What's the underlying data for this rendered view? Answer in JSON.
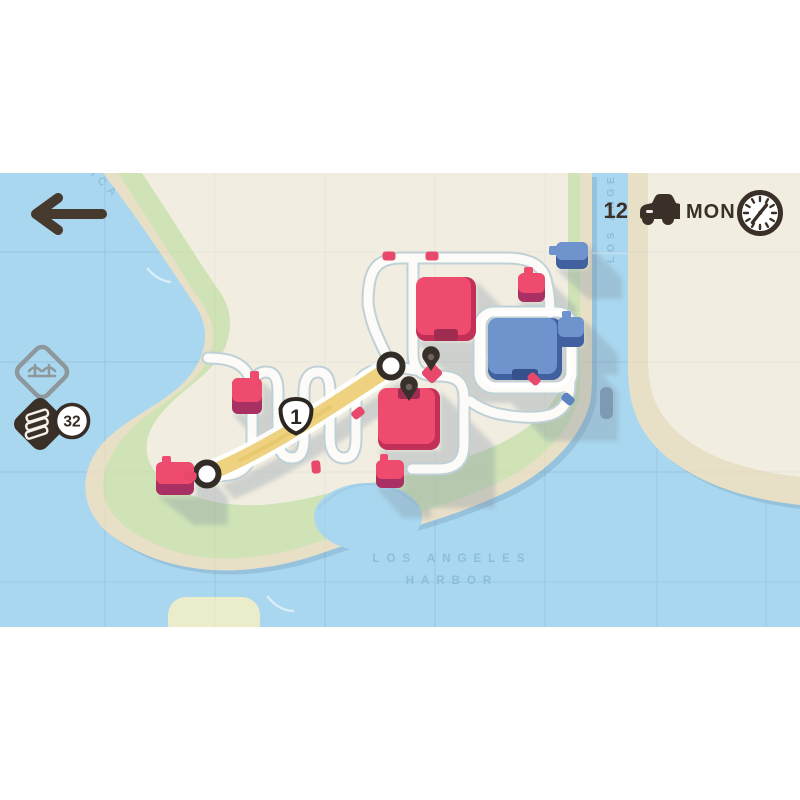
{
  "hud": {
    "back_icon": "arrow-left",
    "vehicle_count": "12",
    "vehicle_icon": "car",
    "day": "MON",
    "clock_icon": "clock",
    "bridge_slot_icon": "suspension-bridge",
    "road_stock_icon": "road-tile-stack",
    "road_tile_count": "32"
  },
  "map": {
    "shield_route": "1",
    "labels": {
      "coast_fragment": "ICA",
      "river": "LOS ANGE",
      "harbor_line1": "LOS ANGELES",
      "harbor_line2": "HARBOR"
    },
    "entities": {
      "red_large_buildings": 2,
      "blue_large_buildings": 1,
      "red_houses": 4,
      "blue_houses": 2,
      "motorway_endpoints": 2,
      "destination_pins": 2,
      "red_cars": 6,
      "blue_cars": 1
    }
  },
  "theme": {
    "water": "#a9d7ef",
    "sand": "#e8dfc7",
    "green": "#cfe3b6",
    "cream": "#f1ede1",
    "road": "#fcfbf7",
    "roadcasing": "#bfd0d6",
    "highway": "#eed27f",
    "red": "#ee4b6e",
    "redDark": "#a93062",
    "blue": "#6f93cd",
    "blueDark": "#41609f",
    "ink": "#3a3028",
    "labelBlue": "#8cbdda"
  }
}
